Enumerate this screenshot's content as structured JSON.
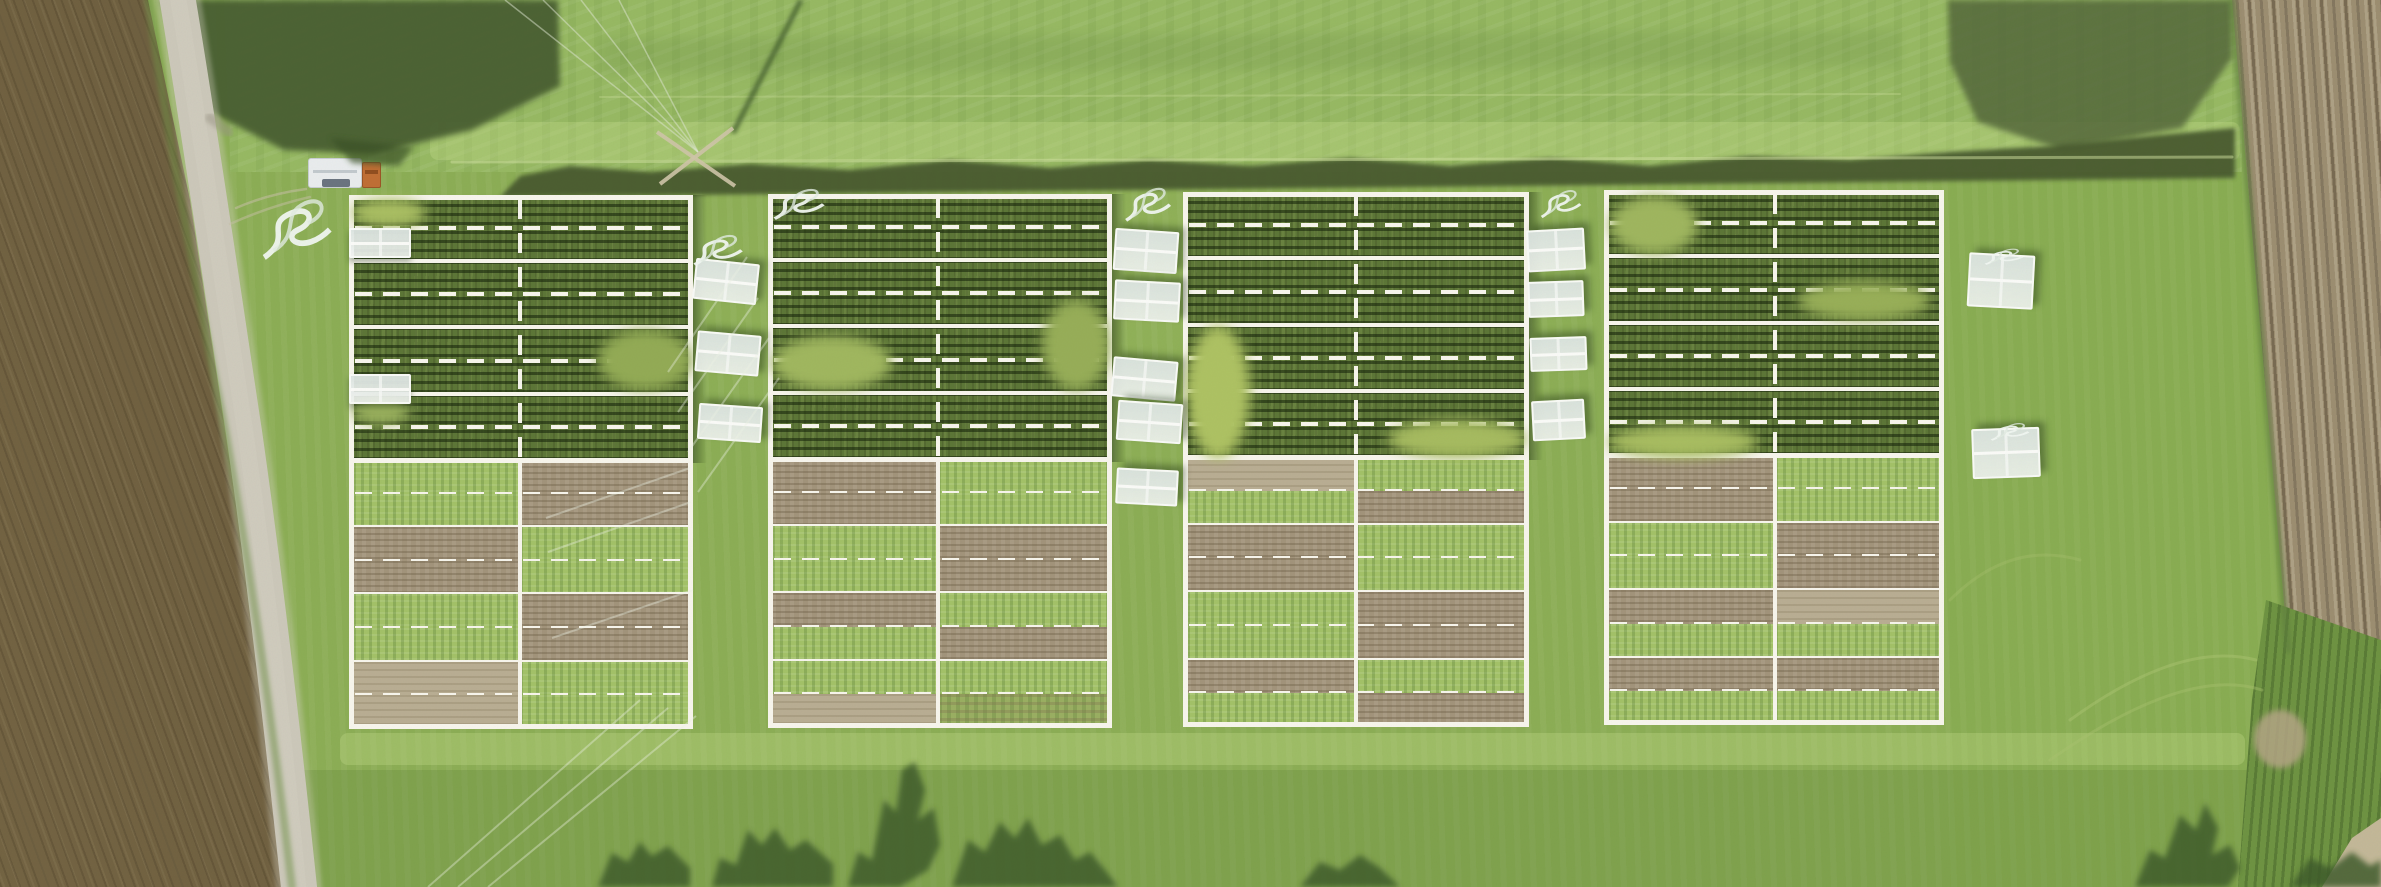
{
  "scene": {
    "width": 2381,
    "height": 887,
    "kind": "aerial-drone-photo-of-field-trial"
  },
  "palette": {
    "grass": "#8cae55",
    "grassTop": "#97b963",
    "line": "#f7f5ec",
    "cropMid": "#5d7637",
    "veg": "#a3c268",
    "soil": "#a2947b",
    "tan": "#b9ae93",
    "dirtL": "#a79b7e",
    "dirtR": "#9c8e71",
    "road": "#ccc8ba",
    "fringe": "#47582e",
    "treeShadow": "#3c5a2a",
    "coverWhite": "#e4eae7",
    "truckWhite": "#e9eced",
    "truckCab": "#c06f35",
    "poleTan": "#cfc5a8"
  },
  "blocks": [
    {
      "x": 349,
      "y": 195,
      "w": 344,
      "h": 534,
      "cx": 0.497,
      "lower": [
        [
          "G",
          "S"
        ],
        [
          "G",
          "S"
        ],
        [
          "S",
          "G"
        ],
        [
          "S",
          "G"
        ],
        [
          "G",
          "S"
        ],
        [
          "G",
          "S"
        ],
        [
          "T",
          "G"
        ],
        [
          "T",
          "G"
        ]
      ]
    },
    {
      "x": 768,
      "y": 194,
      "w": 344,
      "h": 534,
      "cx": 0.494,
      "lower": [
        [
          "S",
          "G"
        ],
        [
          "S",
          "G"
        ],
        [
          "G",
          "S"
        ],
        [
          "G",
          "S"
        ],
        [
          "S",
          "G"
        ],
        [
          "G",
          "S"
        ],
        [
          "G",
          "G"
        ],
        [
          "T",
          "M"
        ]
      ]
    },
    {
      "x": 1183,
      "y": 192,
      "w": 346,
      "h": 535,
      "cx": 0.5,
      "lower": [
        [
          "T",
          "G"
        ],
        [
          "G",
          "S"
        ],
        [
          "S",
          "G"
        ],
        [
          "S",
          "G"
        ],
        [
          "G",
          "S"
        ],
        [
          "G",
          "S"
        ],
        [
          "S",
          "G"
        ],
        [
          "G",
          "S"
        ]
      ]
    },
    {
      "x": 1604,
      "y": 190,
      "w": 340,
      "h": 535,
      "cx": 0.503,
      "lower": [
        [
          "S",
          "G"
        ],
        [
          "S",
          "G"
        ],
        [
          "G",
          "S"
        ],
        [
          "G",
          "S"
        ],
        [
          "S",
          "T"
        ],
        [
          "G",
          "G"
        ],
        [
          "S",
          "S"
        ],
        [
          "G",
          "G"
        ]
      ]
    }
  ],
  "block_geometry": {
    "crop_section_ratio": 0.496,
    "crop_rows": 4,
    "lower_subrows": 8,
    "border_px": 5,
    "solid_px": 4,
    "note": "dashed mid-line in every row, dashed vertical centre line in crop section, solid below"
  },
  "covers": [
    {
      "x": 349,
      "y": 228,
      "w": 62,
      "h": 30,
      "rot": 0,
      "in_block": true
    },
    {
      "x": 349,
      "y": 374,
      "w": 62,
      "h": 30,
      "rot": 0,
      "in_block": true
    },
    {
      "x": 694,
      "y": 261,
      "w": 64,
      "h": 41,
      "rot": 6
    },
    {
      "x": 696,
      "y": 333,
      "w": 64,
      "h": 41,
      "rot": 5
    },
    {
      "x": 698,
      "y": 405,
      "w": 64,
      "h": 36,
      "rot": 4
    },
    {
      "x": 1114,
      "y": 230,
      "w": 64,
      "h": 42,
      "rot": 4
    },
    {
      "x": 1114,
      "y": 281,
      "w": 66,
      "h": 40,
      "rot": 3
    },
    {
      "x": 1112,
      "y": 359,
      "w": 65,
      "h": 40,
      "rot": 5
    },
    {
      "x": 1117,
      "y": 402,
      "w": 65,
      "h": 40,
      "rot": 4
    },
    {
      "x": 1116,
      "y": 469,
      "w": 62,
      "h": 36,
      "rot": 3
    },
    {
      "x": 1527,
      "y": 229,
      "w": 58,
      "h": 42,
      "rot": -3
    },
    {
      "x": 1528,
      "y": 281,
      "w": 56,
      "h": 36,
      "rot": -2
    },
    {
      "x": 1530,
      "y": 337,
      "w": 57,
      "h": 34,
      "rot": -2
    },
    {
      "x": 1532,
      "y": 400,
      "w": 53,
      "h": 40,
      "rot": -3
    },
    {
      "x": 1968,
      "y": 254,
      "w": 66,
      "h": 54,
      "rot": 3
    },
    {
      "x": 1972,
      "y": 428,
      "w": 68,
      "h": 50,
      "rot": -2
    }
  ],
  "hoses": [
    {
      "x": 258,
      "y": 182,
      "w": 78,
      "h": 82
    },
    {
      "x": 690,
      "y": 226,
      "w": 56,
      "h": 42
    },
    {
      "x": 770,
      "y": 180,
      "w": 58,
      "h": 42
    },
    {
      "x": 1122,
      "y": 178,
      "w": 52,
      "h": 46
    },
    {
      "x": 1538,
      "y": 182,
      "w": 46,
      "h": 38
    },
    {
      "x": 1982,
      "y": 244,
      "w": 44,
      "h": 22
    },
    {
      "x": 1988,
      "y": 418,
      "w": 44,
      "h": 24
    }
  ],
  "truck": {
    "x": 308,
    "y": 158,
    "trailer_w": 54,
    "trailer_h": 30,
    "cab_x": 362,
    "cab_y": 162,
    "cab_w": 19,
    "cab_h": 26,
    "wind_x": 322,
    "wind_y": 179,
    "wind_w": 28,
    "wind_h": 8,
    "shadow_pts": "330,138 414,147 399,166 352,163"
  },
  "pole": {
    "bars": [
      [
        657,
        132,
        735,
        186
      ],
      [
        660,
        184,
        733,
        128
      ]
    ],
    "shadow": [
      733,
      133,
      801,
      0
    ],
    "wire_tops": [
      505,
      543,
      581,
      619
    ],
    "wire_to": [
      698,
      152
    ]
  },
  "terrain": {
    "leftfield_clip": "polygon(0px 0px,148px 0px,190px 200px,225px 430px,258px 650px,292px 887px,0px 887px)",
    "rightfield_clip": "polygon(2232px 0px,2381px 0px,2381px 648px,2288px 650px,2270px 440px)",
    "rightstrip_clip": "polygon(2266px 600px,2381px 640px,2381px 887px,2238px 887px,2252px 700px)",
    "cornerdirt_clip": "polygon(2322px 887px,2352px 838px,2381px 818px,2381px 887px)",
    "tanpatch": {
      "x": 2254,
      "y": 710,
      "w": 52,
      "h": 58
    },
    "topfield": {
      "x": 230,
      "y": 0,
      "w": 2012,
      "h": 172
    },
    "mowbands": [
      {
        "x": 430,
        "y": 122,
        "w": 1810,
        "h": 38
      },
      {
        "x": 340,
        "y": 733,
        "w": 1905,
        "h": 32
      }
    ],
    "tints": [
      {
        "cls": "tint-bottom",
        "x": 0,
        "y": 770,
        "w": 2381,
        "h": 117
      },
      {
        "cls": "tint-right",
        "x": 1950,
        "y": 150,
        "w": 431,
        "h": 737
      }
    ],
    "road_d": "M 176,-10 C 198,120 224,300 244,432 C 262,558 280,705 300,897",
    "road_w": 36,
    "field_edge_d": "M 148,0 C 170,150 205,330 225,430 C 245,540 270,700 292,887",
    "right_edge_d": "M 2232,0 C 2250,200 2270,440 2288,650"
  },
  "ground_polys": [
    {
      "pts": "160,0 558,0 560,86 472,130 372,154 284,150 210,112 182,52",
      "fill": "#4a5e30",
      "op": 0.95,
      "blur": 3
    },
    {
      "pts": "1948,0 2232,0 2232,58 2182,128 2062,150 1978,122 1950,62",
      "fill": "#54683a",
      "op": 0.85,
      "blur": 3
    },
    {
      "pts": "600,38 1900,30 1900,66 600,74",
      "fill": "#6d8f46",
      "op": 0.22,
      "blur": 5
    },
    {
      "pts": "500,197 2235,178 2235,128 2150,136 2050,146 1950,152 1850,160 1750,156 1650,166 1550,158 1450,166 1350,158 1250,166 1150,160 1050,168 950,160 850,170 750,164 650,172 570,166 520,176",
      "fill": "#47582e",
      "op": 0.92,
      "blur": 2
    }
  ],
  "ground_paths": [
    {
      "d": "M 176,-10 C 198,120 224,300 244,432 C 262,558 280,705 300,897",
      "w": 46,
      "s": "#d8d4c6",
      "op": 0.35,
      "blur": 2
    },
    {
      "d": "M 176,-10 C 198,120 224,300 244,432 C 262,558 280,705 300,897",
      "w": 36,
      "s": "#ccc8ba",
      "op": 1,
      "blur": 0
    },
    {
      "d": "M 177,-8 C 199,122 225,300 245,430 C 263,556 281,703 299,895",
      "w": 16,
      "s": "#d4d0c2",
      "op": 0.45,
      "blur": 1
    },
    {
      "d": "M 148,0 C 170,150 205,330 225,430 C 245,540 270,700 292,887",
      "w": 8,
      "s": "#6f9146",
      "op": 0.5,
      "blur": 2
    },
    {
      "d": "M 2232,0 C 2250,200 2270,440 2288,650",
      "w": 7,
      "s": "#5e7e3e",
      "op": 0.6,
      "blur": 2
    },
    {
      "d": "M 236,208 Q 268,194 306,189",
      "w": 2.5,
      "s": "#c6bfa6",
      "op": 0.55,
      "blur": 0
    },
    {
      "d": "M 230,224 Q 270,206 310,197",
      "w": 2.5,
      "s": "#c6bfa6",
      "op": 0.5,
      "blur": 0
    },
    {
      "d": "M 452,162 L 2232,157",
      "w": 3,
      "s": "#cfe0a0",
      "op": 0.5,
      "blur": 0
    },
    {
      "d": "M 600,97 L 1900,94",
      "w": 2,
      "s": "#cfe0a0",
      "op": 0.3,
      "blur": 0
    },
    {
      "d": "M 2070,720 Q 2180,640 2256,660",
      "w": 3,
      "s": "#a9c470",
      "op": 0.5,
      "blur": 0
    },
    {
      "d": "M 2050,760 Q 2185,665 2262,690",
      "w": 3,
      "s": "#a9c470",
      "op": 0.4,
      "blur": 0
    },
    {
      "d": "M 1950,600 Q 2010,540 2080,560",
      "w": 3,
      "s": "#a9c470",
      "op": 0.35,
      "blur": 0
    },
    {
      "d": "M 210,118 q 10,6 18,14",
      "w": 10,
      "s": "#9a9484",
      "op": 0.5,
      "blur": 2
    }
  ],
  "glints": [
    {
      "x1": 747,
      "y1": 257,
      "x2": 668,
      "y2": 372
    },
    {
      "x1": 758,
      "y1": 298,
      "x2": 678,
      "y2": 412
    },
    {
      "x1": 769,
      "y1": 338,
      "x2": 688,
      "y2": 452
    },
    {
      "x1": 779,
      "y1": 378,
      "x2": 698,
      "y2": 492
    },
    {
      "x1": 690,
      "y1": 468,
      "x2": 546,
      "y2": 518
    },
    {
      "x1": 691,
      "y1": 502,
      "x2": 548,
      "y2": 552
    },
    {
      "x1": 693,
      "y1": 590,
      "x2": 552,
      "y2": 638
    },
    {
      "x1": 640,
      "y1": 700,
      "x2": 428,
      "y2": 887
    },
    {
      "x1": 668,
      "y1": 708,
      "x2": 458,
      "y2": 887
    },
    {
      "x1": 696,
      "y1": 716,
      "x2": 488,
      "y2": 887
    }
  ],
  "tree_shadows": [
    "598,887 612,853 628,862 640,842 652,856 668,846 690,868 690,887",
    "712,887 720,858 736,865 748,830 762,845 775,828 790,850 806,840 833,864 833,887",
    "848,887 858,852 872,860 884,800 896,812 902,770 915,762 925,790 918,820 934,808 940,845 928,870 900,887",
    "952,887 968,840 985,852 1000,822 1015,838 1028,818 1042,845 1060,835 1075,860 1090,852 1105,870 1118,887",
    "1300,887 1320,862 1340,870 1360,855 1380,868 1400,887",
    "2135,887 2150,850 2165,858 2180,815 2196,830 2205,803 2218,828 2212,855 2230,845 2240,868 2228,887",
    "2290,887 2310,858 2330,868 2352,852 2370,866 2381,860 2381,887"
  ],
  "patches": [
    {
      "x": 352,
      "y": 199,
      "w": 74,
      "h": 28,
      "c": "#aabf63",
      "o": 0.5
    },
    {
      "x": 598,
      "y": 330,
      "w": 94,
      "h": 60,
      "c": "#93ab55",
      "o": 0.45
    },
    {
      "x": 772,
      "y": 336,
      "w": 120,
      "h": 54,
      "c": "#a0b75f",
      "o": 0.5
    },
    {
      "x": 1042,
      "y": 300,
      "w": 68,
      "h": 90,
      "c": "#97ae58",
      "o": 0.4
    },
    {
      "x": 1186,
      "y": 326,
      "w": 64,
      "h": 132,
      "c": "#aec263",
      "o": 0.55
    },
    {
      "x": 1388,
      "y": 420,
      "w": 138,
      "h": 38,
      "c": "#a6bb60",
      "o": 0.45
    },
    {
      "x": 1610,
      "y": 196,
      "w": 88,
      "h": 58,
      "c": "#9fb65f",
      "o": 0.45
    },
    {
      "x": 1798,
      "y": 282,
      "w": 132,
      "h": 38,
      "c": "#98af58",
      "o": 0.4
    },
    {
      "x": 1608,
      "y": 426,
      "w": 150,
      "h": 32,
      "c": "#a8bd61",
      "o": 0.45
    },
    {
      "x": 352,
      "y": 396,
      "w": 58,
      "h": 28,
      "c": "#9cb35f",
      "o": 0.35
    }
  ],
  "gaps": [
    {
      "x": 693,
      "y": 195,
      "w": 14,
      "h": 268
    },
    {
      "x": 1112,
      "y": 194,
      "w": 14,
      "h": 268
    },
    {
      "x": 1529,
      "y": 192,
      "w": 14,
      "h": 268
    }
  ]
}
